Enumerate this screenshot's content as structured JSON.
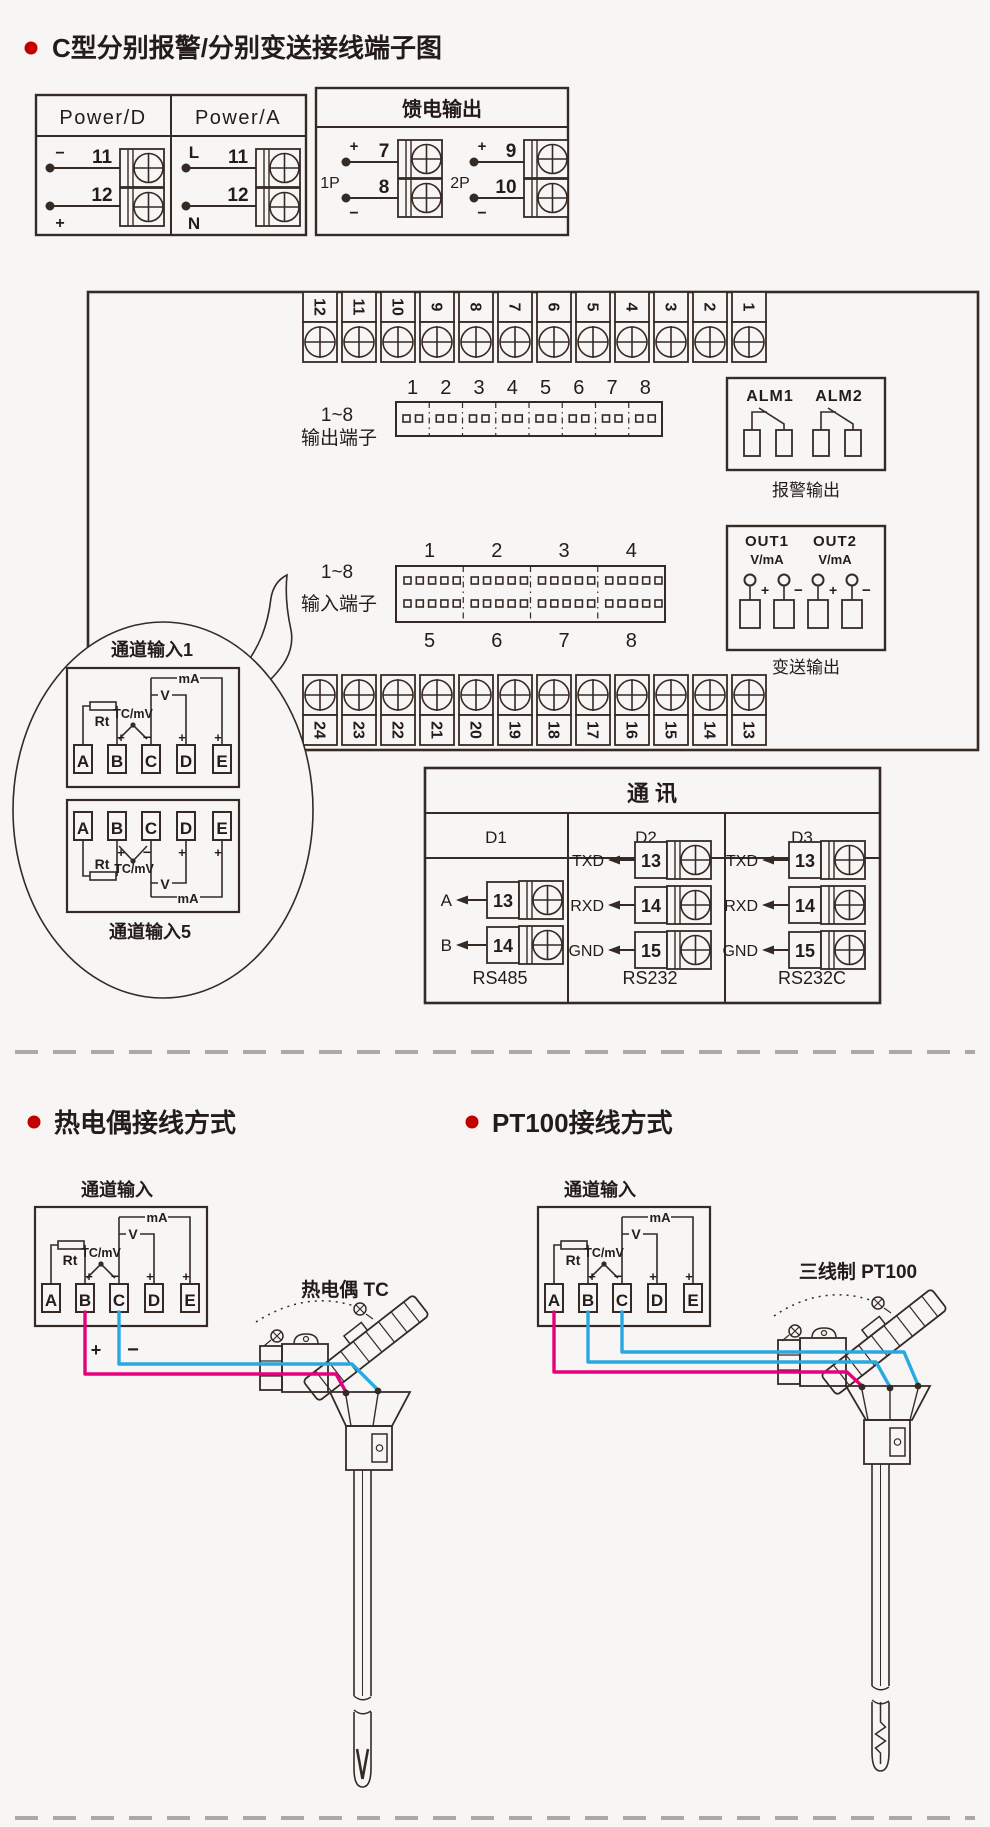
{
  "colors": {
    "background": "#f7f6f4",
    "line": "#362a24",
    "accent_red": "#c30000",
    "wire_pink": "#e6007e",
    "wire_blue": "#29a9e1",
    "divider_gray": "#a9a9a9"
  },
  "title": "C型分别报警/分别变送接线端子图",
  "power": {
    "d_header": "Power/D",
    "a_header": "Power/A",
    "d_rows": [
      {
        "sign": "−",
        "num": "11"
      },
      {
        "sign": "+",
        "num": "12"
      }
    ],
    "a_rows": [
      {
        "sign": "L",
        "num": "11"
      },
      {
        "sign": "N",
        "num": "12"
      }
    ]
  },
  "feed": {
    "header": "馈电输出",
    "groups": [
      {
        "label": "1P",
        "terminals": [
          {
            "sign": "+",
            "num": "7"
          },
          {
            "sign": "−",
            "num": "8"
          }
        ]
      },
      {
        "label": "2P",
        "terminals": [
          {
            "sign": "+",
            "num": "9"
          },
          {
            "sign": "−",
            "num": "10"
          }
        ]
      }
    ]
  },
  "board": {
    "top_strip": [
      "12",
      "11",
      "10",
      "9",
      "8",
      "7",
      "6",
      "5",
      "4",
      "3",
      "2",
      "1"
    ],
    "bottom_strip": [
      "24",
      "23",
      "22",
      "21",
      "20",
      "19",
      "18",
      "17",
      "16",
      "15",
      "14",
      "13"
    ],
    "out_label1": "1~8",
    "out_label2": "输出端子",
    "out_nums": [
      "1",
      "2",
      "3",
      "4",
      "5",
      "6",
      "7",
      "8"
    ],
    "in_label1": "1~8",
    "in_label2": "输入端子",
    "in_nums_top": [
      "1",
      "2",
      "3",
      "4"
    ],
    "in_nums_bot": [
      "5",
      "6",
      "7",
      "8"
    ],
    "alarm": {
      "alm1": "ALM1",
      "alm2": "ALM2",
      "caption": "报警输出"
    },
    "xmit": {
      "out1": "OUT1",
      "out2": "OUT2",
      "unit": "V/mA",
      "plus": "+",
      "minus": "−",
      "caption": "变送输出"
    }
  },
  "balloon": {
    "top_label": "通道输入1",
    "bottom_label": "通道输入5"
  },
  "channel": {
    "terms": [
      "A",
      "B",
      "C",
      "D",
      "E"
    ],
    "rt": "Rt",
    "tc": "TC/mV",
    "v": "V",
    "ma": "mA",
    "plus": "+",
    "minus": "−"
  },
  "comm": {
    "title": "通  讯",
    "cols": [
      {
        "header": "D1",
        "rows": [
          {
            "label": "A",
            "num": "13"
          },
          {
            "label": "B",
            "num": "14"
          }
        ],
        "caption": "RS485"
      },
      {
        "header": "D2",
        "rows": [
          {
            "label": "TXD",
            "num": "13"
          },
          {
            "label": "RXD",
            "num": "14"
          },
          {
            "label": "GND",
            "num": "15"
          }
        ],
        "caption": "RS232"
      },
      {
        "header": "D3",
        "rows": [
          {
            "label": "TXD",
            "num": "13"
          },
          {
            "label": "RXD",
            "num": "14"
          },
          {
            "label": "GND",
            "num": "15"
          }
        ],
        "caption": "RS232C"
      }
    ]
  },
  "section2": {
    "tc_title": "热电偶接线方式",
    "pt_title": "PT100接线方式",
    "channel_label": "通道输入",
    "tc_probe_label": "热电偶 TC",
    "pt_probe_label": "三线制 PT100",
    "plus": "+",
    "minus": "−"
  }
}
